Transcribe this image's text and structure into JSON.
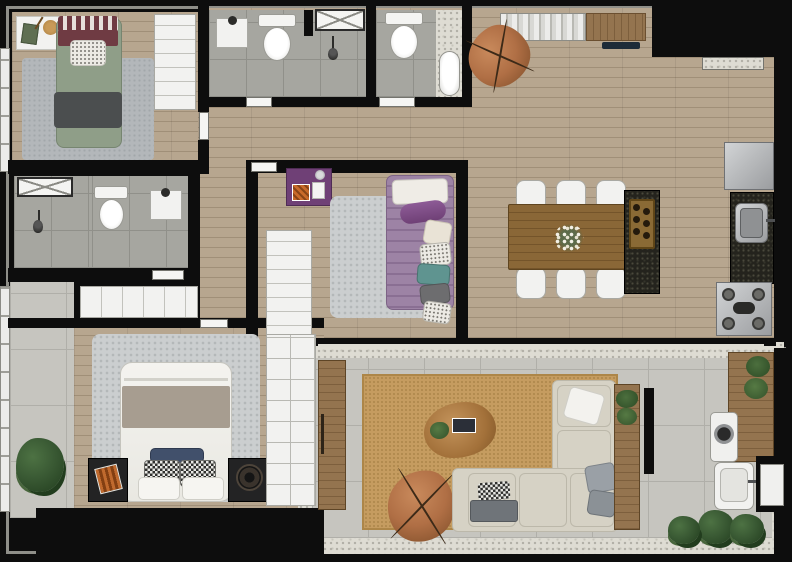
{
  "scene": {
    "title": "Apartment floor plan — photorealistic top-down render",
    "no_visible_text": true
  },
  "palette": {
    "wall": "#0d0d0d",
    "outline": "#8f8f89",
    "wood": "#b7a68f",
    "wood-line": "#a08f78",
    "wood-dark": "#94744f",
    "wood-dark-line": "#7d5f3d",
    "dining-wood": "#8a6737",
    "dining-wood-line": "#74542a",
    "tile": "#a6a6a0",
    "tile-line": "#90908a",
    "concrete": "#c6c5bf",
    "concrete-line": "#b0afa9",
    "speckle-bg": "#dedcd3",
    "speckle-dot": "#b1afa6",
    "white-furn": "#f2f2f0",
    "furn-border": "#a9a9a3",
    "rug-gray": "#b3b7ba",
    "rug-shag": "#cbcecf",
    "rug-tan": "#c59c60",
    "rug-tan-dot": "#b18a4e",
    "bed-green": "#8f9e88",
    "throw-dark": "#4b4e4f",
    "maroon": "#6f3b43",
    "purple": "#9d83a5",
    "purple-dark": "#6f4076",
    "teal": "#5f9490",
    "navy": "#41506b",
    "taupe": "#a79d90",
    "sofa": "#d6d2c5",
    "sofa-line": "#bcb8aa",
    "leather": "#b06f45",
    "leather-dark": "#7c4c28",
    "granite": "#24231d",
    "bronze": "#8a6a35",
    "steel": "#b9bbbd",
    "steel-dark": "#85878a",
    "plant": "#3a5a34",
    "plant-dark": "#223d1e",
    "nightstand": "#232324"
  },
  "rooms": [
    {
      "id": "bedroom-1",
      "name": "Bedroom 1 — single bed, wardrobe, desk"
    },
    {
      "id": "bathroom-1",
      "name": "Bathroom 1 — sink, toilet, shower"
    },
    {
      "id": "bathroom-2",
      "name": "Bathroom 2 — toilet, bathtub"
    },
    {
      "id": "living-dining",
      "name": "Open living / dining / entry"
    },
    {
      "id": "kitchen",
      "name": "Kitchen — fridge, sink counter, stove, island cooktop"
    },
    {
      "id": "bedroom-2",
      "name": "Bedroom 2 — single bed, wardrobe, desk"
    },
    {
      "id": "bathroom-3",
      "name": "En-suite bathroom — toilet, sink, shower"
    },
    {
      "id": "master-bedroom",
      "name": "Master bedroom — double bed, wardrobe, nightstands"
    },
    {
      "id": "side-balcony",
      "name": "Side balcony with plant"
    },
    {
      "id": "terrace",
      "name": "Terrace lounge — rug, sectional sofa, butterfly chair"
    },
    {
      "id": "service-area",
      "name": "Service area — washer, laundry tub, bench, plants"
    }
  ],
  "furniture": {
    "bedroom_1": [
      "single-bed-green",
      "dark-throw-blanket",
      "striped-headboard",
      "gray-rug",
      "wardrobe",
      "desk-with-decor"
    ],
    "bathroom_1": [
      "wall-sink",
      "toilet",
      "shower-box",
      "vent-window"
    ],
    "bathroom_2": [
      "toilet",
      "bathtub"
    ],
    "living_dining": [
      "bookshelf-sideboard",
      "butterfly-chair",
      "entry-threshold",
      "dining-table",
      "six-white-chairs",
      "flower-centerpiece"
    ],
    "kitchen": [
      "refrigerator",
      "granite-counter",
      "steel-sink",
      "gas-stove",
      "island-with-cooktop"
    ],
    "bedroom_2": [
      "single-bed-purple",
      "accent-pillows",
      "shag-rug",
      "wardrobe",
      "purple-desk"
    ],
    "bathroom_3": [
      "toilet",
      "wall-sink",
      "shower-area",
      "vent-window",
      "low-cabinet"
    ],
    "master_bedroom": [
      "double-bed-white",
      "taupe-runner",
      "checkered-pillows",
      "navy-pillow",
      "shag-rug",
      "two-nightstands",
      "wheel-clock",
      "sliding-wardrobe"
    ],
    "side_balcony": [
      "shrub-plant"
    ],
    "terrace": [
      "tan-woven-rug",
      "organic-coffee-table",
      "books",
      "potted-plant",
      "butterfly-chair",
      "l-shaped-sofa",
      "throw-pillows",
      "gray-bench",
      "tall-wood-cabinet",
      "console-with-plants"
    ],
    "service_area": [
      "wood-counter-plants",
      "washing-machine",
      "laundry-tub",
      "garden-plants",
      "utility-door"
    ]
  },
  "counts": {
    "bedrooms": 3,
    "bathrooms": 3,
    "dining_chairs": 6,
    "stove_burners": 4
  }
}
